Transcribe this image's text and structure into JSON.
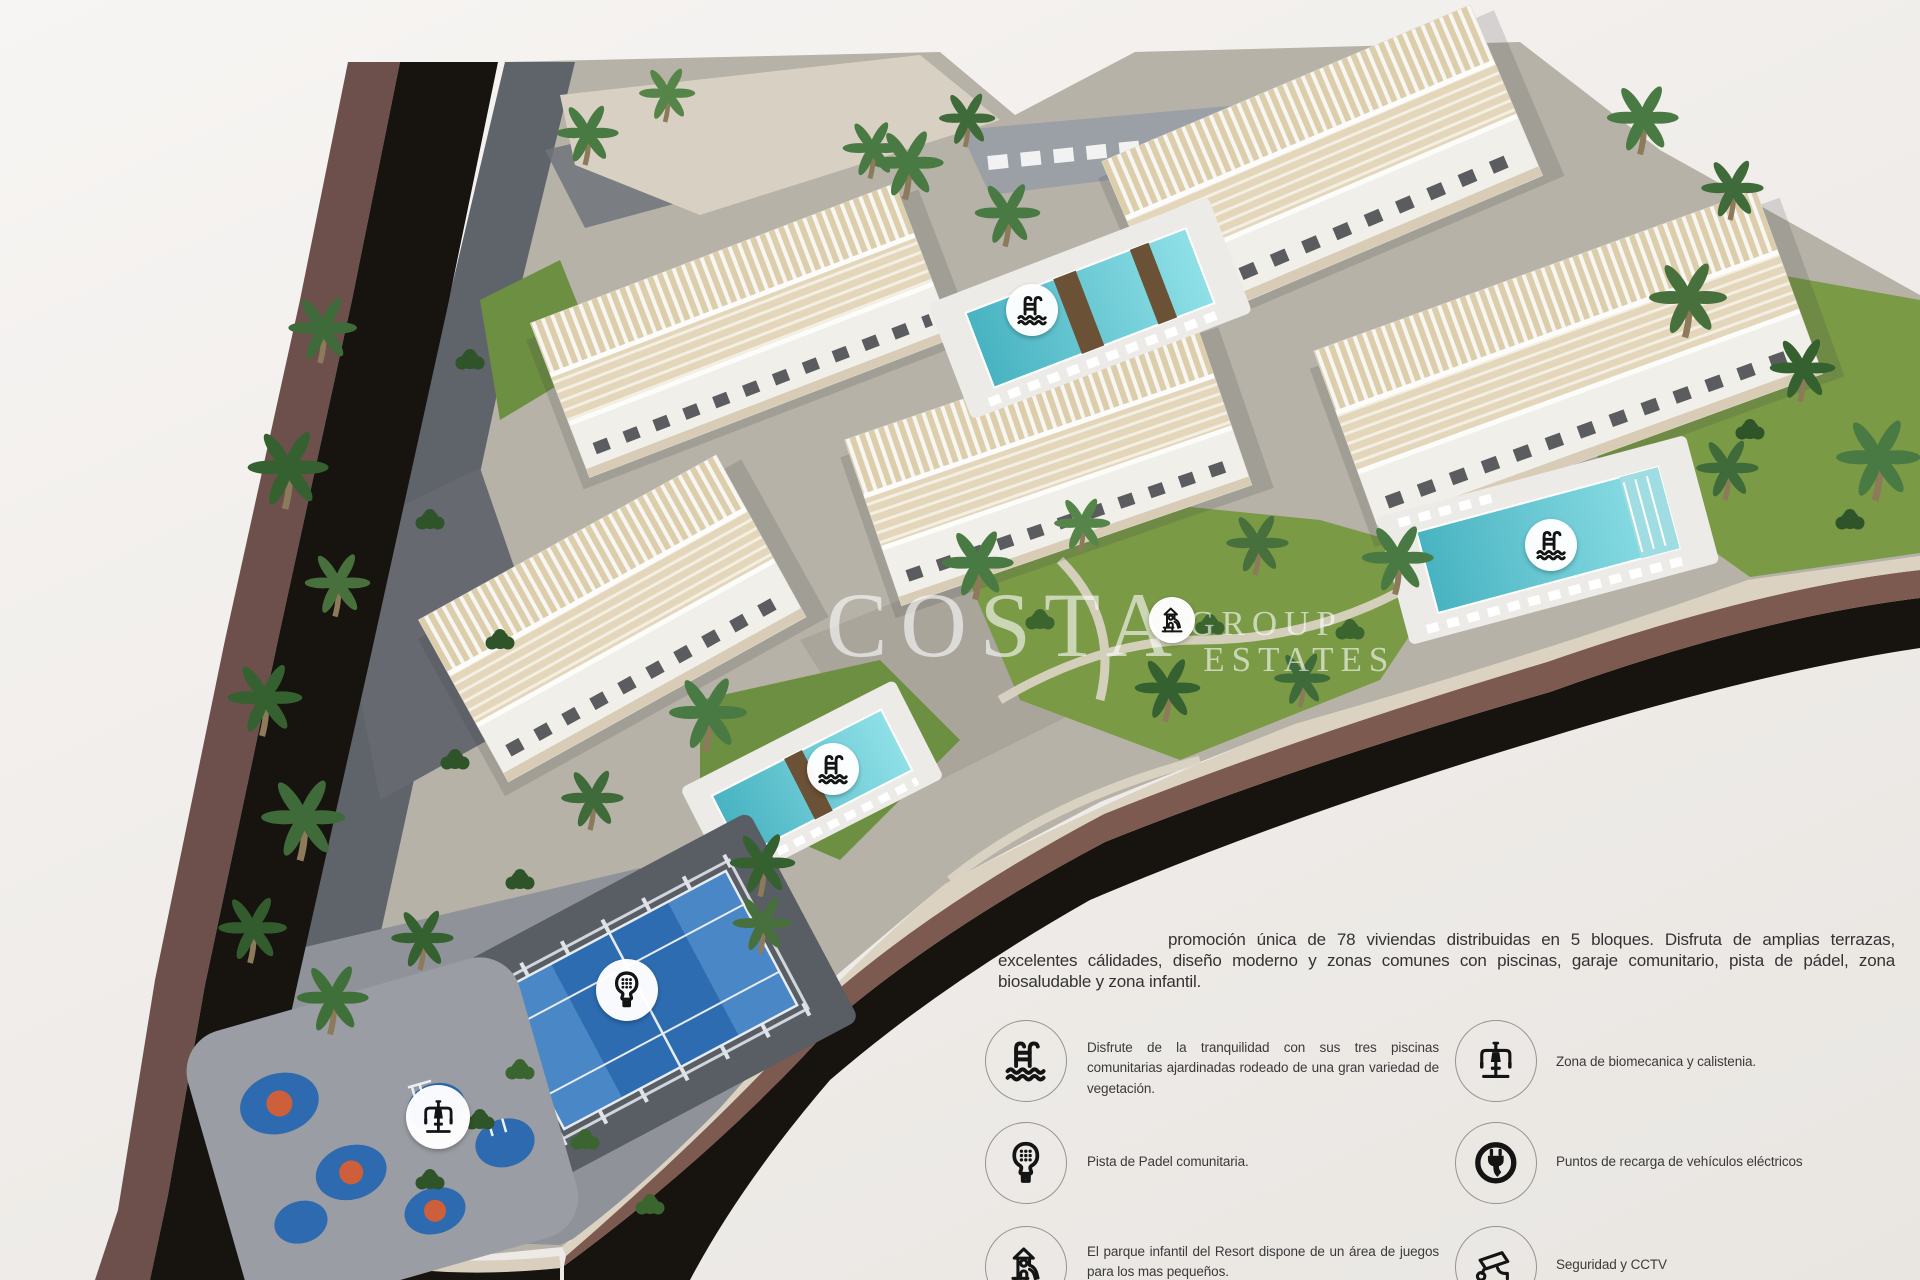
{
  "watermark": {
    "brand": "COSTA",
    "word1": "GROUP",
    "word2": "ESTATES"
  },
  "intro": {
    "text": "promoción única de 78 viviendas distribuidas en 5 bloques. Disfruta de amplias terrazas, excelentes cálidades, diseño moderno y zonas comunes con piscinas, garaje comunitario, pista de pádel, zona biosaludable y zona infantil."
  },
  "legend": {
    "left": [
      {
        "icon": "pool-ladder-icon",
        "text": "Disfrute de la tranquilidad con sus tres piscinas comunitarias ajardinadas rodeado de una gran variedad de vegetación."
      },
      {
        "icon": "padel-racket-icon",
        "text": "Pista de Padel comunitaria."
      },
      {
        "icon": "playground-icon",
        "text": "El parque infantil del Resort dispone de un área de juegos para los mas pequeños."
      }
    ],
    "right": [
      {
        "icon": "biomechanics-icon",
        "text": "Zona de biomecanica y calistenia."
      },
      {
        "icon": "ev-charging-icon",
        "text": "Puntos de recarga de vehículos eléctricos"
      },
      {
        "icon": "cctv-icon",
        "text": "Seguridad y CCTV"
      }
    ]
  },
  "map_markers": [
    {
      "icon": "pool-ladder-icon"
    },
    {
      "icon": "pool-ladder-icon"
    },
    {
      "icon": "pool-ladder-icon"
    },
    {
      "icon": "padel-racket-icon"
    },
    {
      "icon": "biomechanics-icon"
    },
    {
      "icon": "playground-icon"
    }
  ],
  "colors": {
    "background": "#f0edea",
    "road_asphalt": "#17130e",
    "road_bank": "#6d4f4b",
    "retaining_wall": "#dcd2c1",
    "pool_water": "#5fc0cc",
    "padel_court": "#2d6cb1",
    "lawn": "#7a9a46",
    "kids_area_blue": "#2e6ab0",
    "kids_area_orange": "#cd5f3a"
  }
}
